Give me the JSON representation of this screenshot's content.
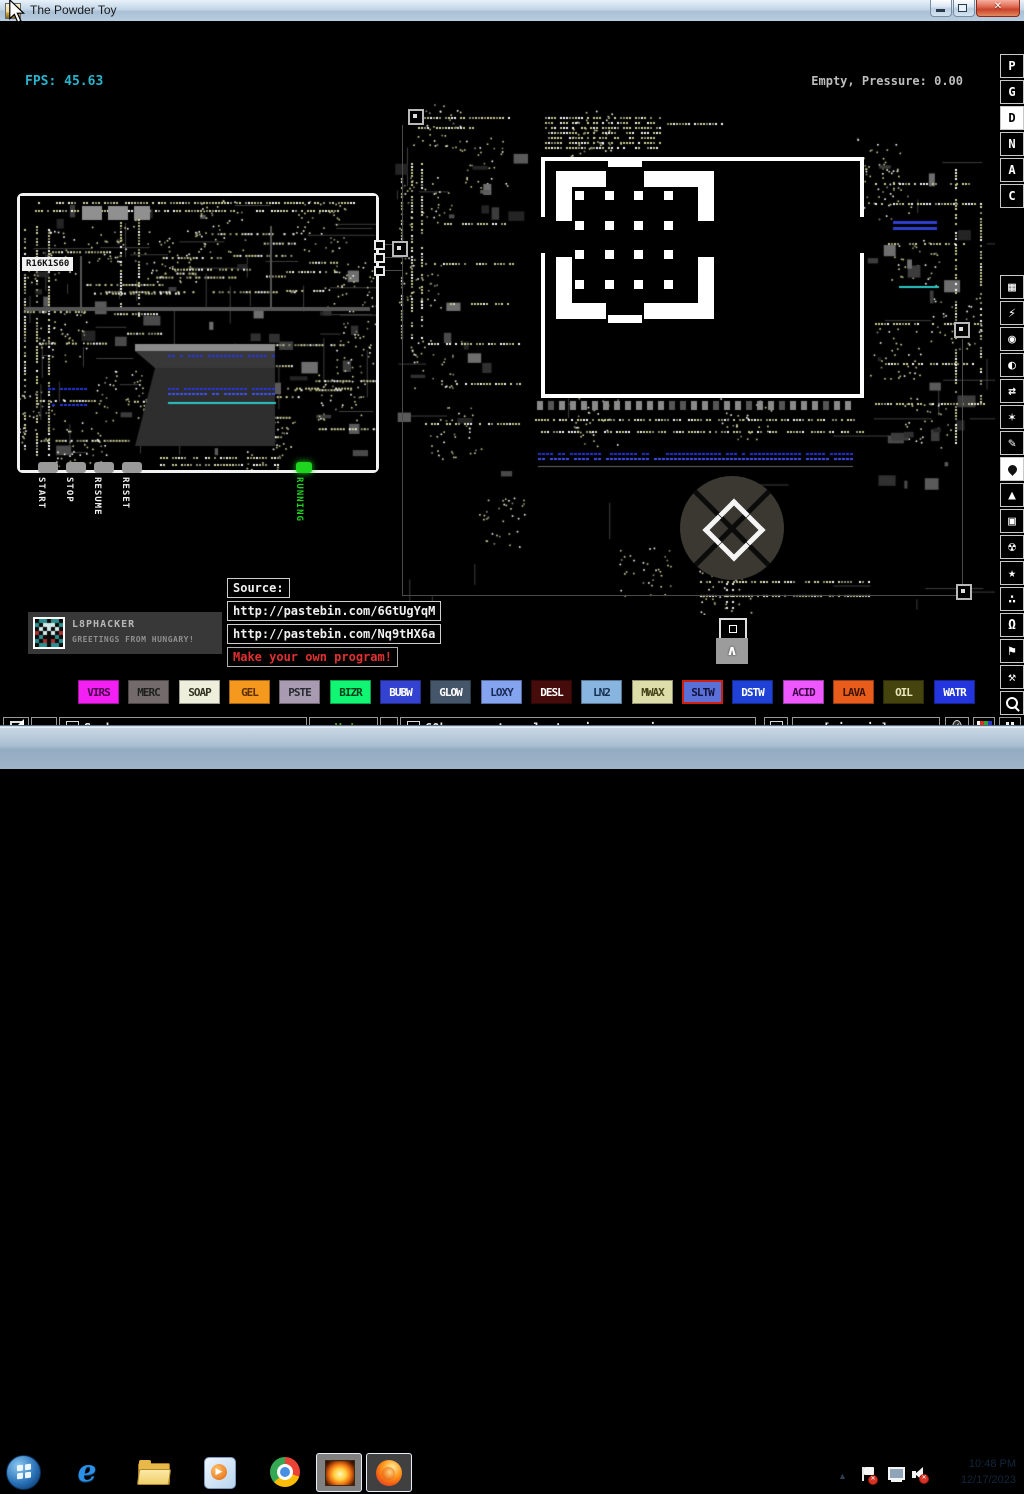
{
  "window": {
    "title": "The Powder Toy",
    "controls": {
      "minimize": "minimize",
      "restore": "restore",
      "close": "close"
    }
  },
  "hud": {
    "fps": "FPS: 45.63",
    "status": "Empty, Pressure: 0.00"
  },
  "sidebar": {
    "letters": [
      {
        "label": "P",
        "selected": false
      },
      {
        "label": "G",
        "selected": false
      },
      {
        "label": "D",
        "selected": true
      },
      {
        "label": "N",
        "selected": false
      },
      {
        "label": "A",
        "selected": false
      },
      {
        "label": "C",
        "selected": false
      }
    ],
    "menus": [
      {
        "name": "walls",
        "glyph": "▦",
        "selected": false
      },
      {
        "name": "electronics",
        "glyph": "⚡",
        "selected": false
      },
      {
        "name": "powered",
        "glyph": "◉",
        "selected": false
      },
      {
        "name": "sensors",
        "glyph": "◐",
        "selected": false
      },
      {
        "name": "force",
        "glyph": "⇄",
        "selected": false
      },
      {
        "name": "explosives",
        "glyph": "✶",
        "selected": false
      },
      {
        "name": "gases",
        "glyph": "✎",
        "selected": false
      },
      {
        "name": "liquids",
        "glyph": "",
        "selected": true
      },
      {
        "name": "powders",
        "glyph": "▲",
        "selected": false
      },
      {
        "name": "solids",
        "glyph": "▣",
        "selected": false
      },
      {
        "name": "radioactive",
        "glyph": "☢",
        "selected": false
      },
      {
        "name": "special",
        "glyph": "★",
        "selected": false
      },
      {
        "name": "life",
        "glyph": "∴",
        "selected": false
      },
      {
        "name": "tools",
        "glyph": "Ω",
        "selected": false
      },
      {
        "name": "decoration",
        "glyph": "⚑",
        "selected": false
      },
      {
        "name": "sandbox-tools",
        "glyph": "⚒",
        "selected": false
      },
      {
        "name": "search",
        "glyph": "",
        "selected": false
      }
    ]
  },
  "board": {
    "chip_label": "R16K1S60",
    "button_labels": [
      "START",
      "STOP",
      "RESUME",
      "RESET"
    ],
    "led_label": "RUNNING"
  },
  "source_panel": {
    "title": "Source:",
    "links": [
      "http://pastebin.com/6GtUgYqM",
      "http://pastebin.com/Nq9tHX6a"
    ],
    "cta": "Make your own program!",
    "cta_color": "#e03030"
  },
  "greeting": {
    "username": "L8PHACKER",
    "message": "GREETINGS FROM HUNGARY!"
  },
  "palette": [
    {
      "label": "VIRS",
      "bg": "#f320f3",
      "fg": "#4a004a",
      "selected": false
    },
    {
      "label": "MERC",
      "bg": "#736b6b",
      "fg": "#1f1f1f",
      "selected": false
    },
    {
      "label": "SOAP",
      "bg": "#eeeedd",
      "fg": "#333322",
      "selected": false
    },
    {
      "label": "GEL",
      "bg": "#f5991e",
      "fg": "#5c2e00",
      "selected": false
    },
    {
      "label": "PSTE",
      "bg": "#a89ab0",
      "fg": "#2a2a33",
      "selected": false
    },
    {
      "label": "BIZR",
      "bg": "#10f572",
      "fg": "#003d1c",
      "selected": false
    },
    {
      "label": "BUBW",
      "bg": "#3342cf",
      "fg": "#ffffff",
      "selected": false
    },
    {
      "label": "GLOW",
      "bg": "#46566a",
      "fg": "#ffffff",
      "selected": false
    },
    {
      "label": "LOXY",
      "bg": "#84a4ef",
      "fg": "#1a2a55",
      "selected": false
    },
    {
      "label": "DESL",
      "bg": "#460c0c",
      "fg": "#ffffff",
      "selected": false
    },
    {
      "label": "LN2",
      "bg": "#88b4e0",
      "fg": "#15304f",
      "selected": false
    },
    {
      "label": "MWAX",
      "bg": "#ddddaa",
      "fg": "#44441a",
      "selected": false
    },
    {
      "label": "SLTW",
      "bg": "#5b6fd9",
      "fg": "#12123c",
      "selected": true
    },
    {
      "label": "DSTW",
      "bg": "#2041d5",
      "fg": "#ffffff",
      "selected": false
    },
    {
      "label": "ACID",
      "bg": "#ee59ff",
      "fg": "#3c0044",
      "selected": false
    },
    {
      "label": "LAVA",
      "bg": "#e85c1c",
      "fg": "#3c1400",
      "selected": false
    },
    {
      "label": "OIL",
      "bg": "#45440f",
      "fg": "#e6e6b8",
      "selected": false
    },
    {
      "label": "WATR",
      "bg": "#2335dc",
      "fg": "#ffffff",
      "selected": false
    }
  ],
  "bottombar": {
    "reload_glyph": "↻",
    "search_text": "Snake game",
    "vote_up_glyph": "▲",
    "vote_up_label": "Vote",
    "vote_down_glyph": "▼",
    "tag_text": "60hz computer electronic game pizzagam...",
    "sign_in_label": "[sign in]"
  },
  "taskbar": {
    "apps": [
      "start",
      "internet-explorer",
      "windows-explorer",
      "media-player",
      "chrome",
      "powder-toy",
      "firefox"
    ],
    "tray_icons": [
      "expand",
      "action-center-flag",
      "network",
      "volume-muted"
    ],
    "clock_time": "10:48 PM",
    "clock_date": "12/17/2023"
  },
  "colors": {
    "fps_accent": "#2ab4cc",
    "selection_red": "#d02010",
    "led_green": "#1fd41f",
    "link_text": "#f0f0f0"
  }
}
